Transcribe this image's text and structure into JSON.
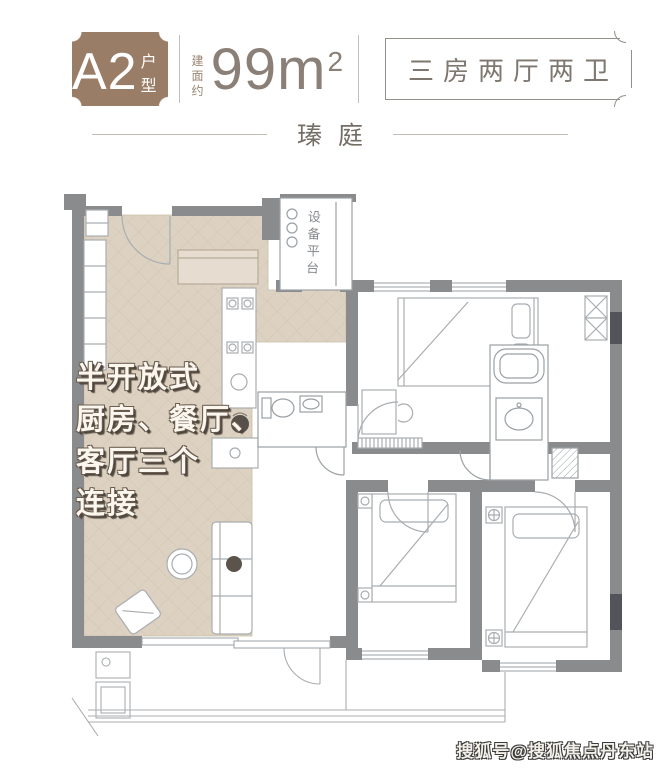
{
  "header": {
    "unit": "A2",
    "unit_suffix": "户型",
    "area_prefix_line1": "建面",
    "area_prefix_line2": "约",
    "area_value": "99m",
    "area_sup": "2",
    "spec": "三房两厅两卫"
  },
  "project": {
    "name": "瑧庭"
  },
  "plan": {
    "equipment_room_label": "设备平台",
    "annotation": "半开放式\n厨房、餐厅、\n客厅三个\n连接"
  },
  "watermark": {
    "text": "搜狐号@搜狐焦点丹东站"
  },
  "colors": {
    "badge_brown": "#9a7d66",
    "heading_text": "#8b8078",
    "spec_text": "#7e776f",
    "wall_gray": "#8a8b8d",
    "wall_dark": "#53545a",
    "floor_beige": "#ded3c2",
    "annotation_text": "#fbf7ef",
    "annotation_shadow": "#4f463d"
  }
}
